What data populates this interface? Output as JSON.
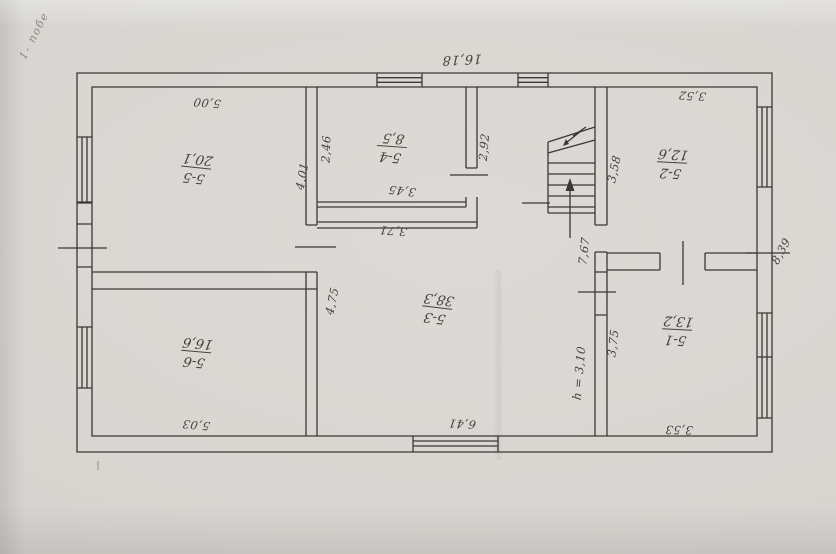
{
  "sheet": {
    "corner_note": "1- побе"
  },
  "floor_plan": {
    "rooms": [
      {
        "id": "5-5",
        "area": "20,1"
      },
      {
        "id": "5-4",
        "area": "8,5"
      },
      {
        "id": "5-2",
        "area": "12,6"
      },
      {
        "id": "5-6",
        "area": "16,6"
      },
      {
        "id": "5-3",
        "area": "38,3"
      },
      {
        "id": "5-1",
        "area": "13,2"
      }
    ],
    "dimensions": {
      "top_total": "16,18",
      "room55_width": "5,00",
      "room52_width": "3,52",
      "wall_246": "2,46",
      "room55_height": "4,01",
      "room54_door_side": "2,92",
      "room54_width": "3,45",
      "wall_371": "3,71",
      "room52_height": "3,58",
      "hall_height": "7,67",
      "room53_wall": "4,75",
      "room51_height": "3,75",
      "height_note": "h = 3,10",
      "room53_width": "6,41",
      "room56_width": "5,03",
      "room51_width": "3,53",
      "right_side": "8,39"
    }
  }
}
